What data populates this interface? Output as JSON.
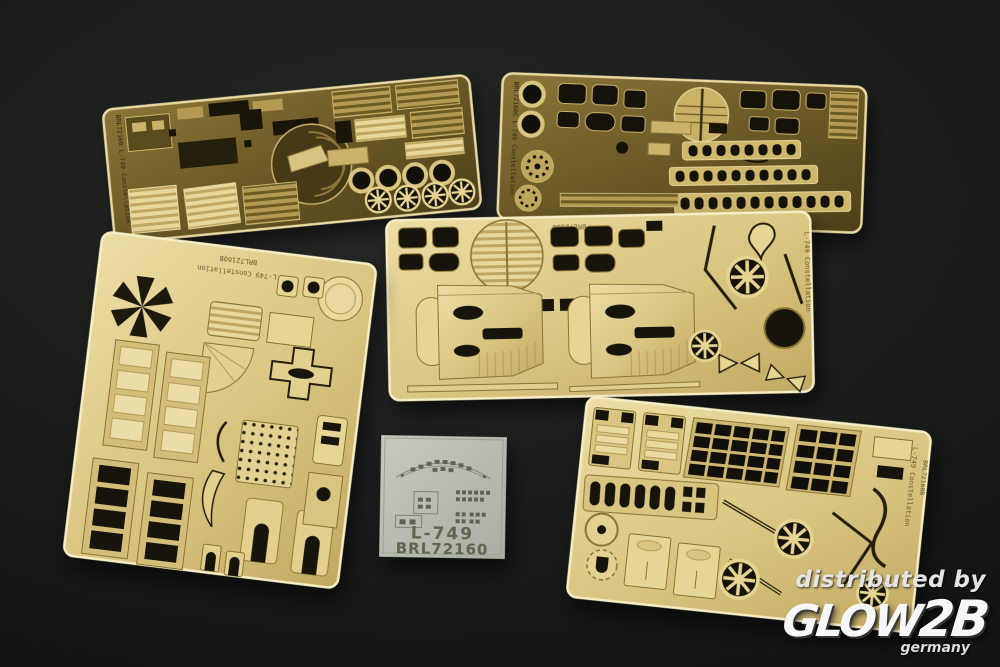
{
  "frets": {
    "top_left": {
      "edge_text": "BRL72160 L-749 Constellation"
    },
    "top_right": {
      "edge_text": "BRL72160C L-749 Constellation"
    },
    "middle": {
      "top_text": "BRL72160",
      "edge_text": "L-749 Constellation"
    },
    "bottom_left": {
      "top_text_line1": "L-749 Constellation",
      "top_text_line2": "BRL72160B"
    },
    "bottom_right": {
      "edge_text_line1": "L-749 Constellation",
      "edge_text_line2": "BRL72160B"
    }
  },
  "decal_sheet": {
    "title": "L-749",
    "code": "BRL72160"
  },
  "watermark": {
    "prefix": "distributed by",
    "brand": "GLOW",
    "brand_suffix": "2B",
    "country": "germany"
  },
  "colors": {
    "background": "#1d1f1d",
    "brass_dark": "#6e5b26",
    "brass_dark_light": "#c8b26a",
    "brass_pale": "#d9c57f",
    "brass_pale_light": "#ecdda4",
    "cutout": "#17140b",
    "decal_paper": "#b7bbb1",
    "decal_text": "#5e6450",
    "watermark_text": "#f0f0f0"
  }
}
